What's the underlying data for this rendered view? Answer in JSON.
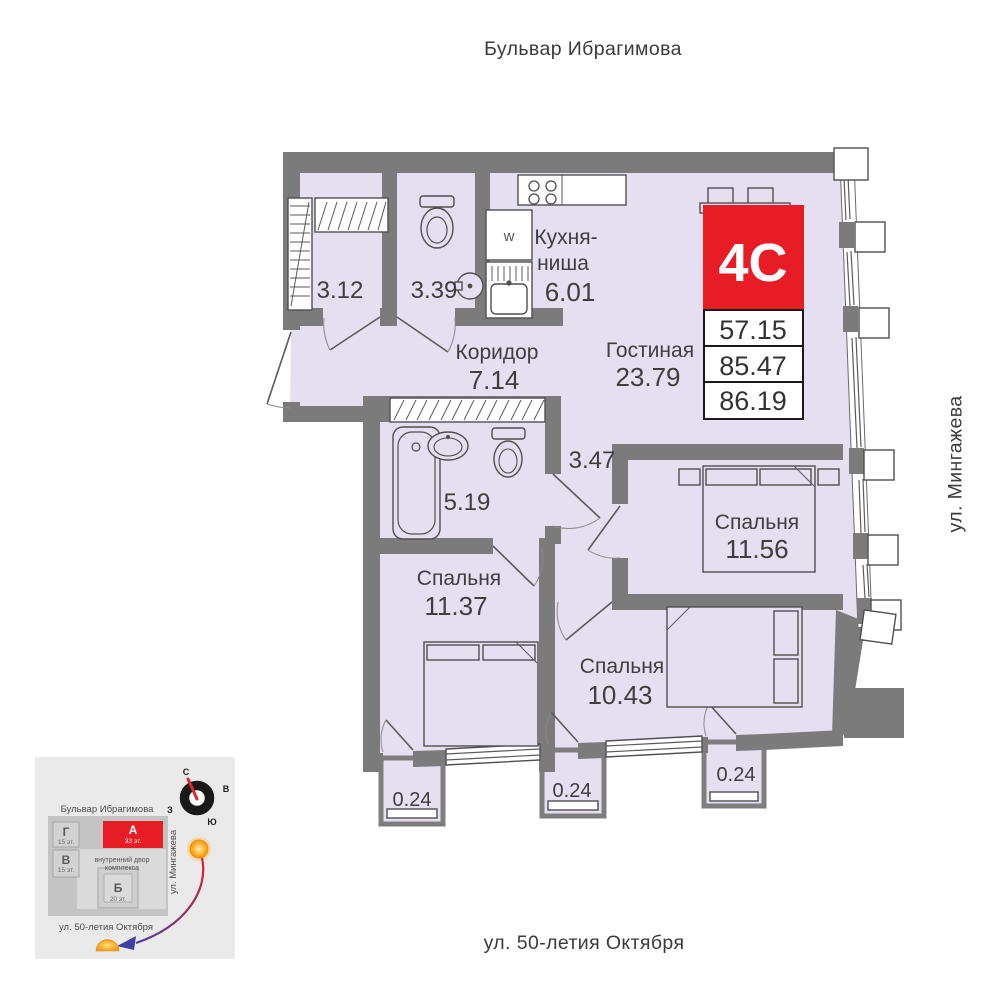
{
  "streets": {
    "top": "Бульвар Ибрагимова",
    "right": "ул. Мингажева",
    "bottom": "ул. 50-летия Октября"
  },
  "unit": {
    "code": "4С",
    "area_rows": [
      "57.15",
      "85.47",
      "86.19"
    ]
  },
  "rooms": {
    "wardrobe": {
      "area": "3.12"
    },
    "bathroom_small": {
      "area": "3.39"
    },
    "kitchen": {
      "name_line1": "Кухня-",
      "name_line2": "ниша",
      "area": "6.01"
    },
    "corridor": {
      "name": "Коридор",
      "area": "7.14"
    },
    "living": {
      "name": "Гостиная",
      "area": "23.79"
    },
    "bathroom": {
      "area": "5.19"
    },
    "hall": {
      "area": "3.47"
    },
    "bedroom_right": {
      "name": "Спальня",
      "area": "11.56"
    },
    "bedroom_left": {
      "name": "Спальня",
      "area": "11.37"
    },
    "bedroom_bottom": {
      "name": "Спальня",
      "area": "10.43"
    },
    "balcony_left": {
      "area": "0.24"
    },
    "balcony_middle": {
      "area": "0.24"
    },
    "balcony_right": {
      "area": "0.24"
    },
    "washer_label": "w"
  },
  "minimap": {
    "street_top": "Бульвар Ибрагимова",
    "street_right": "ул. Мингажева",
    "street_bottom": "ул. 50-летия Октября",
    "courtyard_line1": "внутренний двор",
    "courtyard_line2": "комплекса",
    "buildings": [
      {
        "label": "Г",
        "floors": "15 эт."
      },
      {
        "label": "В",
        "floors": "15 эт."
      },
      {
        "label": "А",
        "floors": "33 эт."
      },
      {
        "label": "Б",
        "floors": "20 эт."
      }
    ],
    "compass": {
      "north": "С",
      "east": "В",
      "south": "Ю",
      "west": "З"
    }
  },
  "colors": {
    "wall": "#7b7b7b",
    "room_fill": "#e6def1",
    "accent_red": "#e81c24"
  }
}
